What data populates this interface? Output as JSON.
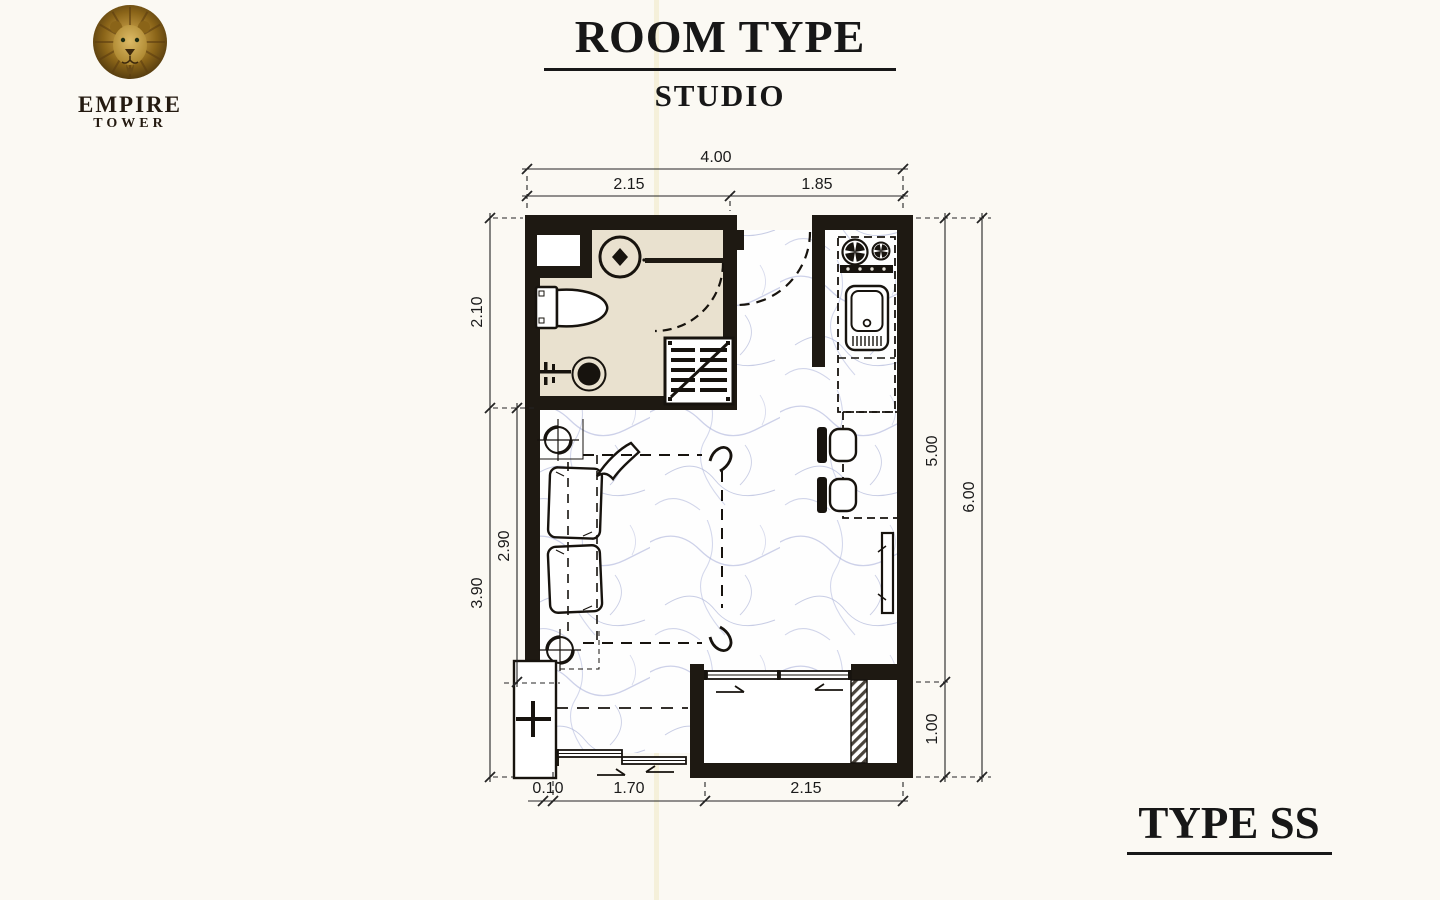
{
  "logo": {
    "icon": "lion-head-icon",
    "line1": "EMPIRE",
    "line2": "TOWER"
  },
  "header": {
    "title": "ROOM TYPE",
    "subtitle": "STUDIO"
  },
  "footer": {
    "type_label": "TYPE SS"
  },
  "floorplan": {
    "units": "meters",
    "dimensions": {
      "top": {
        "total": "4.00",
        "left": "2.15",
        "right": "1.85"
      },
      "left": {
        "bathroom": "2.10",
        "outer": "3.90",
        "inner": "2.90"
      },
      "right": {
        "inner": "5.00",
        "outer": "6.00",
        "balcony": "1.00"
      },
      "bottom": {
        "offset": "0.10",
        "window": "1.70",
        "balcony": "2.15"
      }
    },
    "fixtures": [
      "shower",
      "toilet",
      "wash-basin",
      "louver-cabinet",
      "bathroom-door",
      "entrance-door",
      "stove",
      "kitchen-sink",
      "kitchen-counter",
      "bar-counter",
      "bar-stools",
      "tv",
      "bed",
      "pillows",
      "blanket",
      "ceiling-symbols",
      "sliding-window",
      "balcony-sliding-door",
      "air-conditioner-unit",
      "balcony-shaft"
    ]
  },
  "colors": {
    "wall": "#1e1912",
    "bathroom_floor": "#e9e1cf",
    "marble_vein": "#9aa3d0",
    "logo_gold": "#b78f2e",
    "background": "#fbf9f3"
  }
}
